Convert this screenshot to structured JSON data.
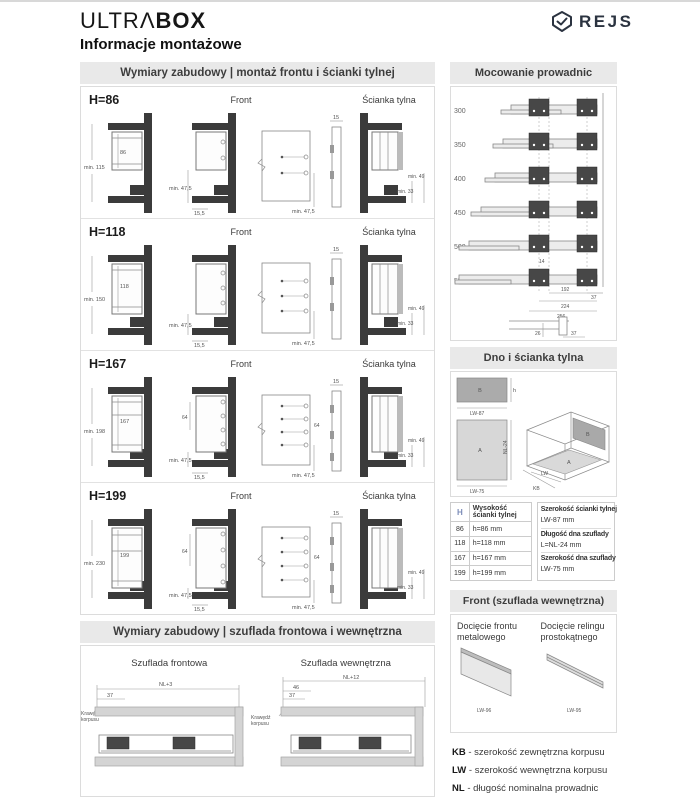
{
  "page": {
    "brand1": "ULTRΛ",
    "brand2": "BOX",
    "rejs": "REJS",
    "title": "Informacje montażowe"
  },
  "left": {
    "header1": "Wymiary zabudowy | montaż frontu i ścianki tylnej",
    "header2": "Wymiary zabudowy | szuflada frontowa i wewnętrzna",
    "rows": [
      {
        "h_label": "H=86",
        "front_label": "Front",
        "back_label": "Ścianka tylna",
        "dim_side_min": "min. 115",
        "dim_h": "86",
        "dim_front_min": "min. 47,5",
        "dim_front_off": "15,5",
        "dim_spacing": "",
        "dim_panel_min": "min. 47,5",
        "dim_strip": "15",
        "dim_back33": "min. 33",
        "dim_back49": "min. 49"
      },
      {
        "h_label": "H=118",
        "front_label": "Front",
        "back_label": "Ścianka tylna",
        "dim_side_min": "min. 150",
        "dim_h": "118",
        "dim_front_min": "min. 47,5",
        "dim_front_off": "15,5",
        "dim_spacing": "",
        "dim_panel_min": "min. 47,5",
        "dim_strip": "15",
        "dim_back33": "min. 33",
        "dim_back49": "min. 49"
      },
      {
        "h_label": "H=167",
        "front_label": "Front",
        "back_label": "Ścianka tylna",
        "dim_side_min": "min. 198",
        "dim_h": "167",
        "dim_front_min": "min. 47,5",
        "dim_front_off": "15,5",
        "dim_spacing": "64",
        "dim_panel_min": "min. 47,5",
        "dim_strip": "15",
        "dim_back33": "min. 33",
        "dim_back49": "min. 49"
      },
      {
        "h_label": "H=199",
        "front_label": "Front",
        "back_label": "Ścianka tylna",
        "dim_side_min": "min. 230",
        "dim_h": "199",
        "dim_front_min": "min. 47,5",
        "dim_front_off": "15,5",
        "dim_spacing": "64",
        "dim_panel_min": "min. 47,5",
        "dim_strip": "15",
        "dim_back33": "min. 33",
        "dim_back49": "min. 49"
      }
    ],
    "bottom": {
      "t1": "Szuflada frontowa",
      "t2": "Szuflada wewnętrzna",
      "front": {
        "nl": "NL+3",
        "d37": "37",
        "edge1": "Krawędź",
        "edge2": "korpusu"
      },
      "inner": {
        "nl": "NL+12",
        "d46": "46",
        "d37": "37",
        "edge1": "Krawędź",
        "edge2": "korpusu"
      }
    }
  },
  "right": {
    "header1": "Mocowanie prowadnic",
    "header2": "Dno i ścianka tylna",
    "header3": "Front (szuflada wewnętrzna)",
    "rails": {
      "lengths": [
        "300",
        "350",
        "400",
        "450",
        "500",
        "550"
      ],
      "d14": "14",
      "d192": "192",
      "d37": "37",
      "d224": "224",
      "d256": "256",
      "d26": "26",
      "d37b": "37"
    },
    "dno": {
      "b": "B",
      "a": "A",
      "b_h": "h",
      "b_w": "LW-87",
      "a_h": "NL-24",
      "a_w": "LW-75",
      "iso_lw": "LW",
      "iso_kb": "KB"
    },
    "table": {
      "h": "H",
      "col": "Wysokość ścianki tylnej",
      "rows": [
        [
          "86",
          "h=86 mm"
        ],
        [
          "118",
          "h=118 mm"
        ],
        [
          "167",
          "h=167 mm"
        ],
        [
          "199",
          "h=199 mm"
        ]
      ],
      "info": [
        [
          "Szerokość ścianki tylnej",
          "LW-87 mm"
        ],
        [
          "Długość dna szuflady",
          "L=NL-24 mm"
        ],
        [
          "Szerokość dna szuflady",
          "LW-75 mm"
        ]
      ]
    },
    "front_cut": {
      "t1": "Docięcie frontu metalowego",
      "t2": "Docięcie relingu prostokątnego",
      "d1": "LW-96",
      "d2": "LW-95"
    },
    "legend": [
      {
        "key": "KB",
        "desc": "- szerokość zewnętrzna korpusu"
      },
      {
        "key": "LW",
        "desc": "- szerokość wewnętrzna korpusu"
      },
      {
        "key": "NL",
        "desc": "- długość nominalna prowadnic"
      }
    ]
  }
}
